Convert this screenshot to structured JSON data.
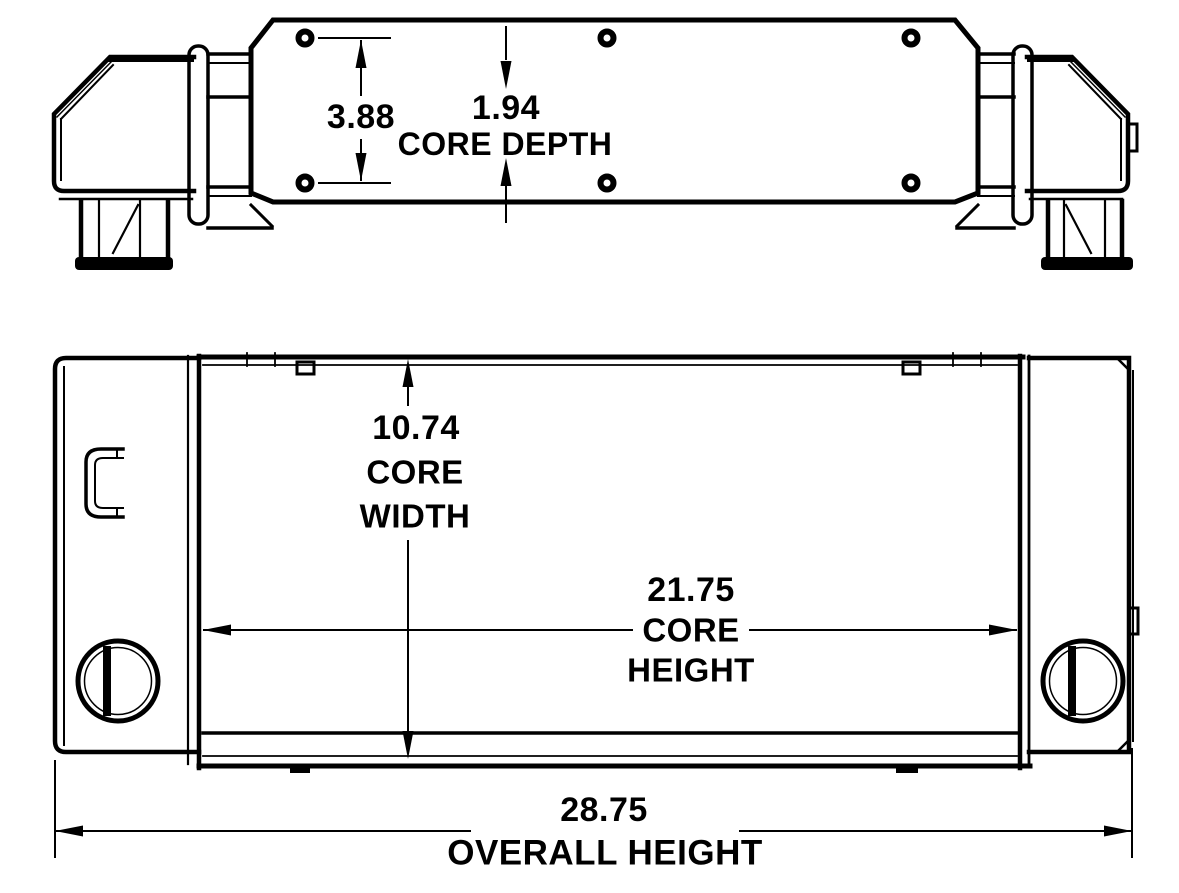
{
  "colors": {
    "line": "#000000",
    "background": "#ffffff"
  },
  "top_view": {
    "dimensions": {
      "hole_spacing": {
        "value": "3.88"
      },
      "core_depth": {
        "value": "1.94",
        "label": "CORE DEPTH"
      }
    }
  },
  "front_view": {
    "dimensions": {
      "core_width": {
        "value": "10.74",
        "label_line1": "CORE",
        "label_line2": "WIDTH"
      },
      "core_height": {
        "value": "21.75",
        "label_line1": "CORE",
        "label_line2": "HEIGHT"
      },
      "overall_height": {
        "value": "28.75",
        "label": "OVERALL HEIGHT"
      }
    }
  }
}
